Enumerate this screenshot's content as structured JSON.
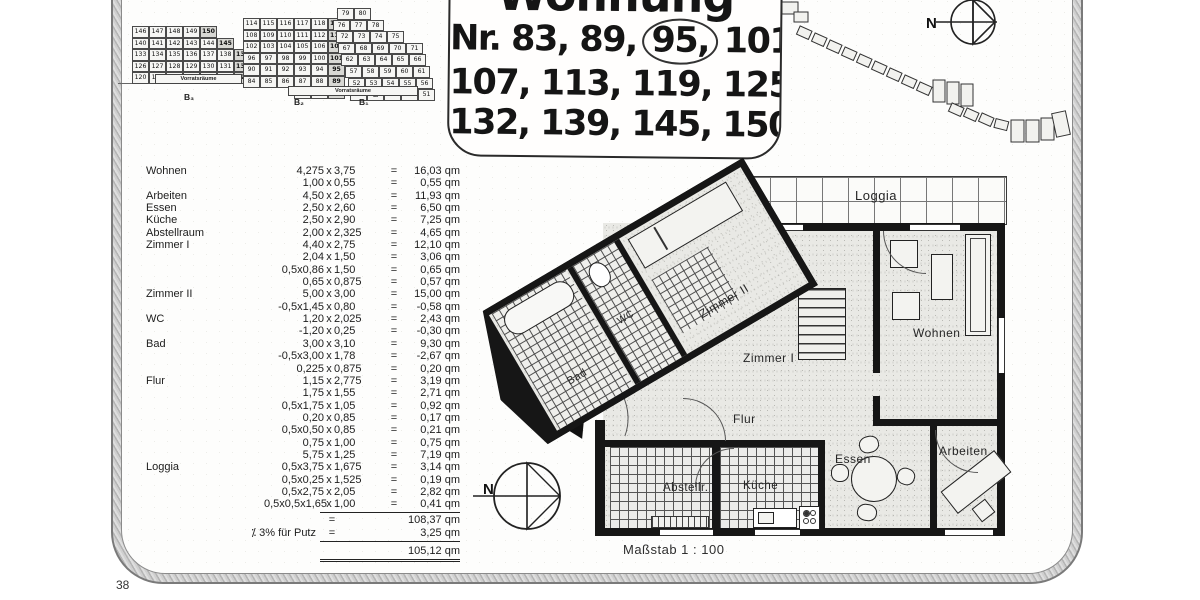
{
  "page": {
    "number": "38"
  },
  "title": {
    "word": "Wohnung",
    "line1_pre": "Nr. 83, 89, ",
    "line1_circled": "95,",
    "line1_post": " 101,",
    "line2": "107, 113, 119, 125,",
    "line3": "132, 139, 145, 150"
  },
  "site_plan": {
    "b3": {
      "rows": [
        [
          "146",
          "147",
          "148",
          "149",
          "150"
        ],
        [
          "140",
          "141",
          "142",
          "143",
          "144",
          "145"
        ],
        [
          "133",
          "134",
          "135",
          "136",
          "137",
          "138",
          "139"
        ],
        [
          "126",
          "127",
          "128",
          "129",
          "130",
          "131",
          "132"
        ],
        [
          "120",
          "121",
          "122",
          "123",
          "124",
          "▨",
          "125"
        ]
      ],
      "store_label": "Vorratsräume",
      "block_label": "B₃"
    },
    "b2": {
      "rows": [
        [
          "114",
          "115",
          "116",
          "117",
          "118",
          "119"
        ],
        [
          "108",
          "109",
          "110",
          "111",
          "112",
          "113"
        ],
        [
          "102",
          "103",
          "104",
          "105",
          "106",
          "107"
        ],
        [
          "96",
          "97",
          "98",
          "99",
          "100",
          "101"
        ],
        [
          "90",
          "91",
          "92",
          "93",
          "94",
          "95"
        ],
        [
          "84",
          "85",
          "86",
          "87",
          "88",
          "89"
        ],
        [
          "",
          "",
          "",
          "81",
          "82",
          "83"
        ]
      ],
      "block_label": "B₂"
    },
    "b1": {
      "rows": [
        [
          "79",
          "80"
        ],
        [
          "76",
          "77",
          "78"
        ],
        [
          "72",
          "73",
          "74",
          "75"
        ],
        [
          "67",
          "68",
          "69",
          "70",
          "71"
        ],
        [
          "62",
          "63",
          "64",
          "65",
          "66"
        ],
        [
          "57",
          "58",
          "59",
          "60",
          "61"
        ],
        [
          "52",
          "53",
          "54",
          "55",
          "56"
        ],
        [
          "48",
          "▨",
          "49",
          "50",
          "51"
        ]
      ],
      "store_label": "Vorratsräume",
      "block_label": "B₁"
    }
  },
  "measurements": {
    "times_sign": "x",
    "equals_sign": "=",
    "rows": [
      {
        "label": "Wohnen",
        "a": "4,275",
        "b": "3,75",
        "area": "16,03 qm"
      },
      {
        "label": "",
        "a": "1,00",
        "b": "0,55",
        "area": "0,55 qm"
      },
      {
        "label": "Arbeiten",
        "a": "4,50",
        "b": "2,65",
        "area": "11,93 qm"
      },
      {
        "label": "Essen",
        "a": "2,50",
        "b": "2,60",
        "area": "6,50 qm"
      },
      {
        "label": "Küche",
        "a": "2,50",
        "b": "2,90",
        "area": "7,25 qm"
      },
      {
        "label": "Abstellraum",
        "a": "2,00",
        "b": "2,325",
        "area": "4,65 qm"
      },
      {
        "label": "Zimmer I",
        "a": "4,40",
        "b": "2,75",
        "area": "12,10 qm"
      },
      {
        "label": "",
        "a": "2,04",
        "b": "1,50",
        "area": "3,06 qm"
      },
      {
        "label": "",
        "a": "0,5x0,86",
        "b": "1,50",
        "area": "0,65 qm"
      },
      {
        "label": "",
        "a": "0,65",
        "b": "0,875",
        "area": "0,57 qm"
      },
      {
        "label": "Zimmer II",
        "a": "5,00",
        "b": "3,00",
        "area": "15,00 qm"
      },
      {
        "label": "",
        "a": "-0,5x1,45",
        "b": "0,80",
        "area": "-0,58 qm"
      },
      {
        "label": "WC",
        "a": "1,20",
        "b": "2,025",
        "area": "2,43 qm"
      },
      {
        "label": "",
        "a": "-1,20",
        "b": "0,25",
        "area": "-0,30 qm"
      },
      {
        "label": "Bad",
        "a": "3,00",
        "b": "3,10",
        "area": "9,30 qm"
      },
      {
        "label": "",
        "a": "-0,5x3,00",
        "b": "1,78",
        "area": "-2,67 qm"
      },
      {
        "label": "",
        "a": "0,225",
        "b": "0,875",
        "area": "0,20 qm"
      },
      {
        "label": "Flur",
        "a": "1,15",
        "b": "2,775",
        "area": "3,19 qm"
      },
      {
        "label": "",
        "a": "1,75",
        "b": "1,55",
        "area": "2,71 qm"
      },
      {
        "label": "",
        "a": "0,5x1,75",
        "b": "1,05",
        "area": "0,92 qm"
      },
      {
        "label": "",
        "a": "0,20",
        "b": "0,85",
        "area": "0,17 qm"
      },
      {
        "label": "",
        "a": "0,5x0,50",
        "b": "0,85",
        "area": "0,21 qm"
      },
      {
        "label": "",
        "a": "0,75",
        "b": "1,00",
        "area": "0,75 qm"
      },
      {
        "label": "",
        "a": "5,75",
        "b": "1,25",
        "area": "7,19 qm"
      },
      {
        "label": "Loggia",
        "a": "0,5x3,75",
        "b": "1,675",
        "area": "3,14 qm"
      },
      {
        "label": "",
        "a": "0,5x0,25",
        "b": "1,525",
        "area": "0,19 qm"
      },
      {
        "label": "",
        "a": "0,5x2,75",
        "b": "2,05",
        "area": "2,82 qm"
      },
      {
        "label": "",
        "a": "0,5x0,5x1,65",
        "b": "1,00",
        "area": "0,41 qm"
      }
    ],
    "subtotal": "108,37 qm",
    "deduction_label": "⁒ 3% für Putz",
    "deduction": "3,25 qm",
    "total": "105,12 qm"
  },
  "floor_plan": {
    "labels": {
      "loggia": "Loggia",
      "zimmer2": "Zimmer II",
      "zimmer1": "Zimmer I",
      "wohnen": "Wohnen",
      "bad": "Bad",
      "wc": "WC",
      "flur": "Flur",
      "essen": "Essen",
      "kueche": "Küche",
      "abstell": "Abstellr.",
      "arbeiten": "Arbeiten"
    },
    "scale_label": "Maßstab 1 : 100"
  },
  "compass": {
    "north_label": "N"
  }
}
